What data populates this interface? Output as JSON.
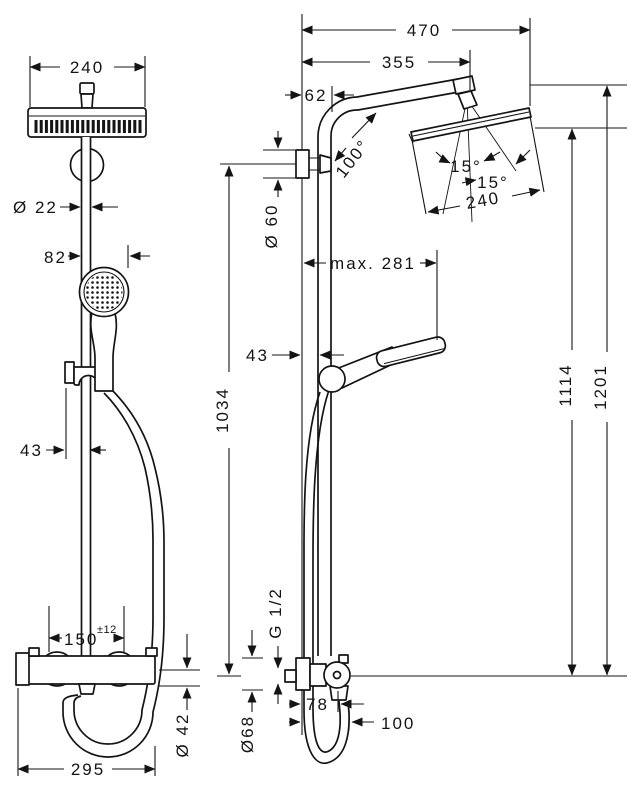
{
  "drawing": {
    "front_view": {
      "head_width": "240",
      "pipe_diameter": "Ø 22",
      "hand_shower_offset": "82",
      "bracket_depth": "43",
      "connection_distance": "150",
      "connection_tolerance": "±12",
      "valve_body_diameter": "Ø 42",
      "overall_width": "295"
    },
    "side_view": {
      "projection_total": "470",
      "projection_arm": "355",
      "wall_clearance": "62",
      "arm_angle": "100°",
      "head_tilt_a": "15°",
      "head_tilt_b": "15°",
      "head_depth": "240",
      "wall_bracket_diameter": "Ø 60",
      "max_handshower_reach": "max. 281",
      "bar_wall_clearance": "43",
      "bar_height": "1034",
      "height_to_head": "1114",
      "height_total": "1201",
      "thread_size": "G 1/2",
      "escutcheon_diameter": "Ø68",
      "valve_knob_depth": "78",
      "hose_clearance": "100"
    }
  },
  "colors": {
    "ink": "#141414",
    "background": "#ffffff"
  }
}
